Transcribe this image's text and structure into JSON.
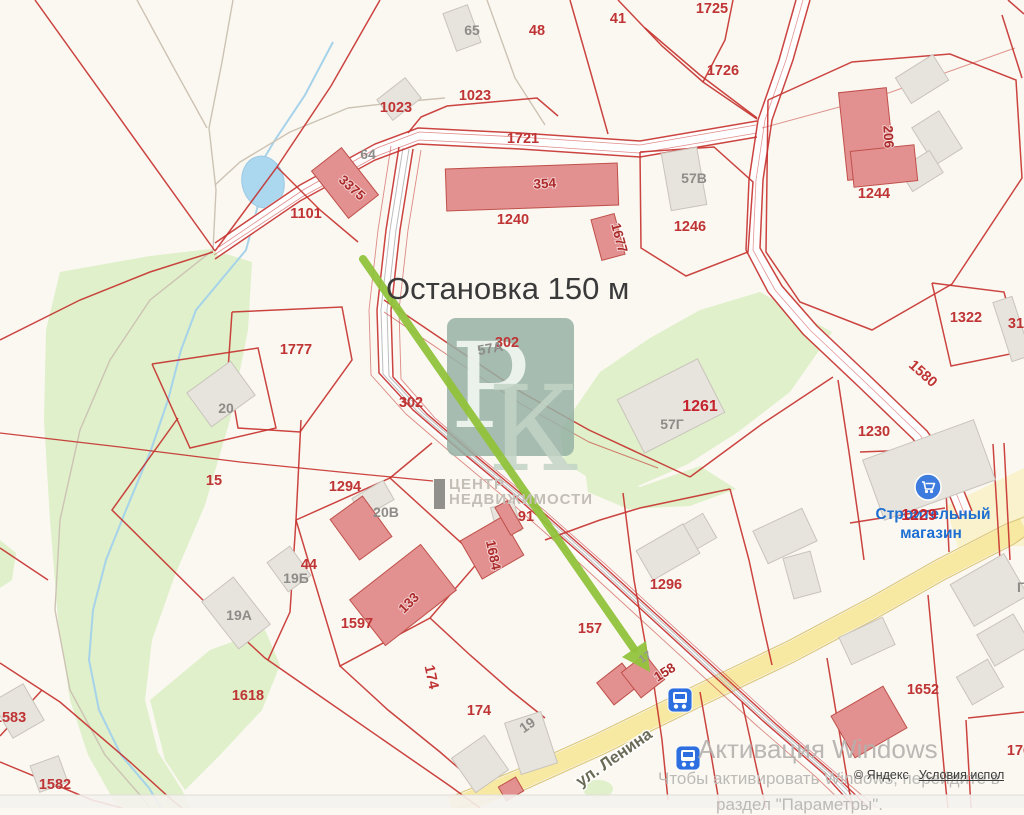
{
  "annotation": {
    "text": "Остановка 150 м"
  },
  "watermark": {
    "letter1": "Р",
    "letter2": "К",
    "org_line1": "ЦЕНТР",
    "org_line2": "НЕДВИЖИМОСТИ"
  },
  "activation": {
    "line1": "Активация Windows",
    "line2": "Чтобы активировать Windows, перейдите в",
    "line3": "раздел \"Параметры\"."
  },
  "attribution": {
    "copyright": "© Яндекс",
    "terms": "Условия испол"
  },
  "street": {
    "name": "ул. Ленина"
  },
  "colors": {
    "background": "#FBF8F2",
    "parcel_red": "#C5302C",
    "green": "#DFF0CA",
    "pale_yellow": "#FAF0C2",
    "road_yellow": "#F7E8A2",
    "road_yellow_edge": "#DCC87E",
    "water_fill": "#ABD7EF",
    "water_stroke": "#9CC9E4",
    "stream": "#A6D3EA",
    "gray_bldg": "#E7E3DD",
    "gray_bldg_stroke": "#C9C4BB",
    "red_bldg": "#E29090",
    "red_bldg_stroke": "#C0504A",
    "trail": "#CDC3B4",
    "rail_gray": "#BDBDBD",
    "arrow_green": "#92C33C",
    "bus_blue": "#2E6FE0",
    "store_blue": "#3D7CDE",
    "watermark_box": "rgba(150,177,164,0.85)"
  },
  "map": {
    "green_areas": [
      "60,272 150,256 210,249 252,262 248,330 230,420 205,505 175,575 152,640 145,700 158,752 182,790 190,808 118,808 88,755 70,700 58,620 50,520 44,420 46,330",
      "150,700 210,650 265,630 280,665 262,710 220,755 185,790 165,760",
      "0,540 16,553 12,580 0,588",
      "560,430 600,372 650,338 700,310 760,292 832,332 790,392 738,432 688,464 638,486 598,484 564,462",
      "585,470 640,487 700,466 736,489 690,506 628,509 588,492"
    ],
    "pale_areas": [
      "946,506 1024,468 1024,546 958,548"
    ],
    "green_ellipse": {
      "cx": 598,
      "cy": 789,
      "rx": 15,
      "ry": 9
    },
    "pond": {
      "cx": 263,
      "cy": 182,
      "rx": 21,
      "ry": 26,
      "rot": -12
    },
    "stream": "333,42 305,95 275,140 263,160 258,205 246,250 221,280 196,310 181,350 168,400 151,450 126,510 106,560 93,610 89,660 99,710 121,755 149,788 161,808",
    "white_roads": [
      {
        "p": "215,251 300,193 375,152 418,136 520,141 640,149 757,129",
        "w": 15
      },
      {
        "p": "803,0 786,60 765,120 756,180 753,250 775,290 810,330 865,382 920,435 950,478 965,515",
        "w": 14
      },
      {
        "p": "406,148 393,230 384,310 386,375 420,412 470,455 530,505 590,558 650,613 710,668 770,723 830,775 862,808",
        "w": 13
      }
    ],
    "yellow_road": {
      "p": "452,808 520,780 600,744 700,695 790,652 875,607 940,570 1010,534 1024,527",
      "w": 19,
      "edges": [
        "448,798 516,770 596,734 696,685 786,642 871,597 936,560 1006,524 1024,517",
        "458,808 524,790 604,754 704,705 794,662 879,617 944,580 1014,544 1024,537"
      ]
    },
    "trails": [
      "137,0 175,70 207,128",
      "233,0 222,62 209,128",
      "209,128 216,190 213,250",
      "213,250 150,300 110,360 80,430 60,520 55,610 70,690 105,755 140,795 150,808",
      "487,0 515,78 545,125",
      "348,108 400,102 445,98",
      "348,108 290,132 240,162 215,185"
    ],
    "rails": [
      "403,148 390,230 381,310 383,374 417,411 467,454 527,504 587,557 647,612 707,667 767,722 827,774 859,808",
      "409,149 396,230 387,310 389,376 423,413 473,456 533,506 593,559 653,614 713,669 773,724 833,776 865,808"
    ],
    "lines": [
      "35,0 215,251",
      "380,0 331,86 277,167 215,251",
      "277,167 320,210 358,242",
      "408,133 421,117 447,106 537,98 558,116",
      "570,0 590,70 608,134",
      "618,0 662,46 703,82 757,119",
      "645,28 700,75 757,118",
      "703,82 725,40 733,0",
      "932,283 1004,292 1020,352 951,366 932,283",
      "1002,15 1022,78",
      "1008,0 1024,14",
      "640,152 714,147 753,182 748,252 686,276 641,248 640,152",
      "768,100 852,62 950,54 1016,80 1022,178 952,284 872,330 800,302 766,252 768,100",
      "690,477 762,424 833,377",
      "838,380 849,452 859,522 864,560",
      "860,452 944,449",
      "944,449 949,552",
      "993,444 1000,560",
      "1004,443 1010,560",
      "384,300 452,346 521,392 589,430 690,477",
      {
        "p": "384,312 452,358 521,404 589,442 658,468",
        "w": 1,
        "o": 0.6
      },
      "623,493 634,580 650,670",
      "730,489 749,560 763,625 772,665",
      "640,508 730,489",
      "545,540 600,520 640,508",
      "0,340 80,300 150,272 213,252",
      "232,312 342,307 352,360 300,432 238,428 228,370 232,312",
      "152,364 258,348 276,428 190,448 152,364",
      {
        "p": "0,433 120,447 240,462 360,474 433,481",
        "w": 1.2
      },
      "178,418 112,510 213,610",
      "301,420 296,520 290,612 268,660",
      "213,610 265,658 330,703 395,748 450,786 480,808",
      "296,520 390,478 480,560 430,618 340,666 296,520",
      "390,478 432,443",
      "430,618 470,655 510,690 545,718",
      "340,666 388,710 440,752 470,778",
      "0,548 48,580",
      "0,663 60,702 130,762 172,800 182,808",
      "0,736 42,690",
      "0,762 92,800 122,808",
      "652,672 662,740 668,800",
      "700,692 712,760 720,808",
      "742,702 757,770 766,808",
      "827,658 839,730 849,790 853,808",
      "928,595 936,680 946,790 948,808",
      "968,718 1024,712",
      "966,720 971,808",
      "850,523 945,508",
      {
        "p": "762,128 880,96 1015,48",
        "w": 1,
        "o": 0.5
      },
      "215,243 300,185 375,144 418,128 520,133 640,141 757,121",
      "215,259 300,201 375,160 418,144 520,149 640,157 757,137",
      {
        "p": "219,247 303,190 377,148 419,132 520,137 640,145 756,125",
        "w": 0.8,
        "o": 0.55
      },
      {
        "p": "214,255 302,197 377,156 419,140 520,145 640,153 757,133",
        "w": 0.8,
        "o": 0.55
      },
      "796,0 779,60 758,120 749,180 746,250 768,292 803,334 858,386 913,439 944,482 959,519",
      "810,0 793,60 772,120 763,180 760,248 782,286 817,326 872,378 927,431 957,474 972,511",
      {
        "p": "803,0 786,60 765,120 756,180 753,250 775,290 810,330 865,382 920,435 950,478 965,515",
        "w": 0.8,
        "o": 0.5
      },
      "399,147 386,230 377,310 379,373 413,410 463,453 523,503 583,556 643,611 703,666 763,721 823,773 855,808",
      "413,149 400,230 391,310 393,377 427,414 477,457 537,507 597,560 657,615 717,670 777,725 837,777 869,808",
      {
        "p": "391,146 378,230 369,310 371,375 406,414 456,457 516,507 576,560 636,615 696,670 756,725 816,777 848,808",
        "w": 0.9,
        "o": 0.55
      },
      {
        "p": "421,150 408,230 399,310 401,379 435,418 485,461 545,511 605,564 665,619 725,674 785,729 845,781 877,808",
        "w": 0.9,
        "o": 0.55
      }
    ],
    "buildings": [
      {
        "x": 449,
        "y": 8,
        "w": 26,
        "h": 40,
        "r": -20,
        "t": "g"
      },
      {
        "x": 381,
        "y": 86,
        "w": 36,
        "h": 26,
        "r": -38,
        "t": "g"
      },
      {
        "x": 666,
        "y": 150,
        "w": 36,
        "h": 58,
        "r": -10,
        "t": "g"
      },
      {
        "x": 900,
        "y": 64,
        "w": 44,
        "h": 30,
        "r": -32,
        "t": "g"
      },
      {
        "x": 921,
        "y": 116,
        "w": 32,
        "h": 44,
        "r": -32,
        "t": "g"
      },
      {
        "x": 903,
        "y": 158,
        "w": 36,
        "h": 26,
        "r": -32,
        "t": "g"
      },
      {
        "x": 626,
        "y": 376,
        "w": 90,
        "h": 60,
        "r": -27,
        "t": "g"
      },
      {
        "x": 1002,
        "y": 298,
        "w": 20,
        "h": 62,
        "r": -18,
        "t": "g"
      },
      {
        "x": 194,
        "y": 373,
        "w": 54,
        "h": 42,
        "r": -36,
        "t": "g"
      },
      {
        "x": 216,
        "y": 583,
        "w": 40,
        "h": 60,
        "r": -38,
        "t": "g"
      },
      {
        "x": 275,
        "y": 551,
        "w": 28,
        "h": 36,
        "r": -36,
        "t": "g"
      },
      {
        "x": 355,
        "y": 488,
        "w": 36,
        "h": 22,
        "r": -30,
        "t": "g"
      },
      {
        "x": 494,
        "y": 504,
        "w": 24,
        "h": 30,
        "r": -15,
        "t": "g"
      },
      {
        "x": 870,
        "y": 438,
        "w": 118,
        "h": 64,
        "r": -20,
        "t": "g"
      },
      {
        "x": 678,
        "y": 520,
        "w": 34,
        "h": 28,
        "r": -30,
        "t": "g"
      },
      {
        "x": 843,
        "y": 626,
        "w": 48,
        "h": 30,
        "r": -25,
        "t": "g"
      },
      {
        "x": 641,
        "y": 535,
        "w": 54,
        "h": 34,
        "r": -30,
        "t": "g"
      },
      {
        "x": 512,
        "y": 716,
        "w": 38,
        "h": 54,
        "r": -18,
        "t": "g"
      },
      {
        "x": 460,
        "y": 743,
        "w": 40,
        "h": 42,
        "r": -35,
        "t": "g"
      },
      {
        "x": 0,
        "y": 690,
        "w": 36,
        "h": 42,
        "r": -30,
        "t": "g"
      },
      {
        "x": 34,
        "y": 760,
        "w": 30,
        "h": 28,
        "r": -20,
        "t": "g"
      },
      {
        "x": 958,
        "y": 566,
        "w": 62,
        "h": 48,
        "r": -30,
        "t": "g"
      },
      {
        "x": 983,
        "y": 622,
        "w": 42,
        "h": 36,
        "r": -30,
        "t": "g"
      },
      {
        "x": 962,
        "y": 666,
        "w": 36,
        "h": 32,
        "r": -30,
        "t": "g"
      },
      {
        "x": 788,
        "y": 554,
        "w": 28,
        "h": 42,
        "r": -15,
        "t": "g"
      },
      {
        "x": 758,
        "y": 518,
        "w": 54,
        "h": 36,
        "r": -25,
        "t": "g"
      },
      {
        "x": 446,
        "y": 166,
        "w": 172,
        "h": 42,
        "r": -2,
        "t": "r"
      },
      {
        "x": 326,
        "y": 153,
        "w": 38,
        "h": 60,
        "r": -38,
        "t": "r"
      },
      {
        "x": 843,
        "y": 90,
        "w": 48,
        "h": 88,
        "r": -6,
        "t": "r"
      },
      {
        "x": 852,
        "y": 148,
        "w": 64,
        "h": 36,
        "r": -6,
        "t": "r"
      },
      {
        "x": 596,
        "y": 216,
        "w": 24,
        "h": 42,
        "r": -15,
        "t": "r"
      },
      {
        "x": 341,
        "y": 503,
        "w": 40,
        "h": 50,
        "r": -36,
        "t": "r"
      },
      {
        "x": 358,
        "y": 566,
        "w": 90,
        "h": 58,
        "r": -38,
        "t": "r"
      },
      {
        "x": 468,
        "y": 526,
        "w": 48,
        "h": 44,
        "r": -30,
        "t": "r"
      },
      {
        "x": 502,
        "y": 502,
        "w": 14,
        "h": 32,
        "r": -30,
        "t": "r"
      },
      {
        "x": 602,
        "y": 670,
        "w": 32,
        "h": 28,
        "r": -38,
        "t": "r"
      },
      {
        "x": 628,
        "y": 660,
        "w": 30,
        "h": 32,
        "r": -38,
        "t": "r"
      },
      {
        "x": 839,
        "y": 698,
        "w": 60,
        "h": 48,
        "r": -30,
        "t": "r"
      },
      {
        "x": 501,
        "y": 781,
        "w": 20,
        "h": 16,
        "r": -30,
        "t": "r"
      }
    ],
    "watermark_box": {
      "x": 447,
      "y": 318,
      "w": 127,
      "h": 138,
      "rx": 9,
      "p_x": 490,
      "p_y": 427,
      "k_x": 533,
      "k_y": 470
    },
    "arrow": {
      "x1": 363,
      "y1": 259,
      "x2": 634,
      "y2": 649,
      "head": "650,672 646,641 622,657",
      "w": 8
    },
    "bus_stops": [
      {
        "x": 680,
        "y": 700
      },
      {
        "x": 688,
        "y": 758
      }
    ],
    "store_icon": {
      "x": 928,
      "y": 487,
      "r": 13
    },
    "labels": [
      {
        "t": "1725",
        "x": 712,
        "y": 13,
        "c": "p"
      },
      {
        "t": "41",
        "x": 618,
        "y": 23,
        "c": "p"
      },
      {
        "t": "48",
        "x": 537,
        "y": 35,
        "c": "p"
      },
      {
        "t": "65",
        "x": 472,
        "y": 35,
        "c": "g"
      },
      {
        "t": "1023",
        "x": 396,
        "y": 112,
        "c": "p"
      },
      {
        "t": "1023",
        "x": 475,
        "y": 100,
        "c": "p"
      },
      {
        "t": "1721",
        "x": 523,
        "y": 143,
        "c": "p"
      },
      {
        "t": "1726",
        "x": 723,
        "y": 75,
        "c": "p"
      },
      {
        "t": "64",
        "x": 368,
        "y": 159,
        "c": "g"
      },
      {
        "t": "3375",
        "x": 349,
        "y": 191,
        "c": "bldgred",
        "r": 42
      },
      {
        "t": "354",
        "x": 545,
        "y": 188,
        "c": "bldgred",
        "r": -3
      },
      {
        "t": "206",
        "x": 884,
        "y": 137,
        "c": "bldgred",
        "r": 87
      },
      {
        "t": "57В",
        "x": 694,
        "y": 183,
        "c": "g"
      },
      {
        "t": "1244",
        "x": 874,
        "y": 198,
        "c": "p"
      },
      {
        "t": "1246",
        "x": 690,
        "y": 231,
        "c": "p"
      },
      {
        "t": "1677",
        "x": 615,
        "y": 239,
        "c": "bldgred",
        "r": 75
      },
      {
        "t": "1101",
        "x": 306,
        "y": 218,
        "c": "p"
      },
      {
        "t": "1240",
        "x": 513,
        "y": 224,
        "c": "p"
      },
      {
        "t": "1322",
        "x": 966,
        "y": 322,
        "c": "p"
      },
      {
        "t": "31",
        "x": 1016,
        "y": 328,
        "c": "p"
      },
      {
        "t": "1580",
        "x": 920,
        "y": 377,
        "c": "p",
        "r": 42
      },
      {
        "t": "1777",
        "x": 296,
        "y": 354,
        "c": "p"
      },
      {
        "t": "302",
        "x": 507,
        "y": 347,
        "c": "p"
      },
      {
        "t": "57А",
        "x": 491,
        "y": 353,
        "c": "g",
        "r": -10
      },
      {
        "t": "302",
        "x": 411,
        "y": 407,
        "c": "p"
      },
      {
        "t": "1261",
        "x": 700,
        "y": 411,
        "c": "pb"
      },
      {
        "t": "57Г",
        "x": 672,
        "y": 429,
        "c": "g"
      },
      {
        "t": "1230",
        "x": 874,
        "y": 436,
        "c": "p"
      },
      {
        "t": "Г",
        "x": 1021,
        "y": 592,
        "c": "g"
      },
      {
        "t": "20",
        "x": 226,
        "y": 413,
        "c": "g"
      },
      {
        "t": "15",
        "x": 214,
        "y": 485,
        "c": "p"
      },
      {
        "t": "1294",
        "x": 345,
        "y": 491,
        "c": "p"
      },
      {
        "t": "20В",
        "x": 386,
        "y": 517,
        "c": "g"
      },
      {
        "t": "91",
        "x": 526,
        "y": 521,
        "c": "p"
      },
      {
        "t": "1684",
        "x": 489,
        "y": 556,
        "c": "bldgred",
        "r": 78
      },
      {
        "t": "Строительный",
        "x": 933,
        "y": 519,
        "c": "store"
      },
      {
        "t": "магазин",
        "x": 931,
        "y": 538,
        "c": "store"
      },
      {
        "t": "1229",
        "x": 919,
        "y": 520,
        "c": "pb"
      },
      {
        "t": "1296",
        "x": 666,
        "y": 589,
        "c": "p"
      },
      {
        "t": "44",
        "x": 309,
        "y": 569,
        "c": "p"
      },
      {
        "t": "19Б",
        "x": 296,
        "y": 583,
        "c": "g"
      },
      {
        "t": "19А",
        "x": 239,
        "y": 620,
        "c": "g"
      },
      {
        "t": "133",
        "x": 412,
        "y": 606,
        "c": "bldgred",
        "r": -45
      },
      {
        "t": "1597",
        "x": 357,
        "y": 628,
        "c": "p"
      },
      {
        "t": "157",
        "x": 590,
        "y": 633,
        "c": "p"
      },
      {
        "t": "17",
        "x": 647,
        "y": 660,
        "c": "gs",
        "r": -33
      },
      {
        "t": "158",
        "x": 667,
        "y": 676,
        "c": "bldgred",
        "r": -32
      },
      {
        "t": "1618",
        "x": 248,
        "y": 700,
        "c": "p"
      },
      {
        "t": "174",
        "x": 427,
        "y": 678,
        "c": "p",
        "r": 78
      },
      {
        "t": "174",
        "x": 479,
        "y": 715,
        "c": "p"
      },
      {
        "t": "19",
        "x": 530,
        "y": 729,
        "c": "g",
        "r": -35
      },
      {
        "t": "1583",
        "x": 10,
        "y": 722,
        "c": "p"
      },
      {
        "t": "1582",
        "x": 55,
        "y": 789,
        "c": "p"
      },
      {
        "t": "1652",
        "x": 923,
        "y": 694,
        "c": "p"
      },
      {
        "t": "176",
        "x": 1019,
        "y": 755,
        "c": "p"
      },
      {
        "t": "ул. Ленина",
        "x": 617,
        "y": 762,
        "c": "street",
        "r": -35
      }
    ]
  }
}
